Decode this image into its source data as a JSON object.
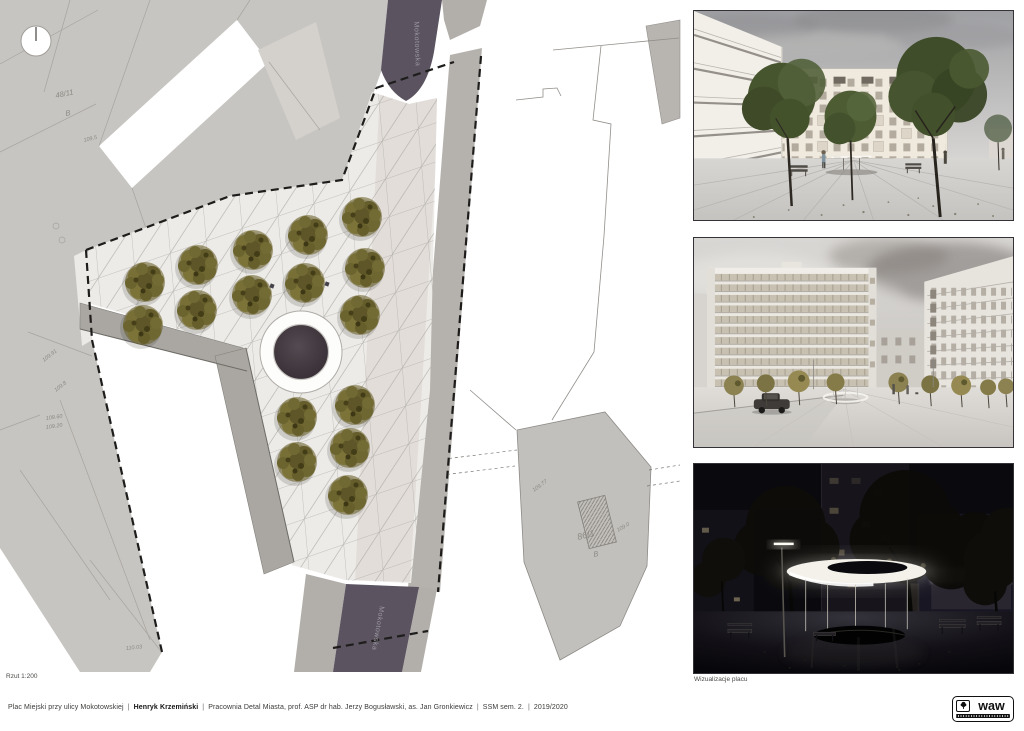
{
  "plan": {
    "caption": "Rzut 1:200",
    "street_top": "Mokotowska",
    "street_bottom": "Mokotowska",
    "tree_count": 16,
    "labels": [
      {
        "text": "48/11"
      },
      {
        "text": "B"
      },
      {
        "text": "109.5"
      },
      {
        "text": "109.91"
      },
      {
        "text": "109.8"
      },
      {
        "text": "109.60"
      },
      {
        "text": "109.20"
      },
      {
        "text": "110.03"
      },
      {
        "text": "86/1"
      },
      {
        "text": "B"
      },
      {
        "text": "109.77"
      },
      {
        "text": "109.0"
      }
    ],
    "colors": {
      "parcel": "#c7c5c1",
      "road": "#5b5460",
      "plaza": "#edebe7",
      "tree": "#6e662f",
      "pool": "#463d44"
    }
  },
  "renders": {
    "caption": "Wizualizacje placu"
  },
  "footer": {
    "separator": "|",
    "project": "Plac Miejski przy ulicy Mokotowskiej",
    "author": "Henryk Krzemiński",
    "studio": "Pracownia Detal Miasta, prof. ASP dr hab. Jerzy Bogusławski, as. Jan Gronkiewicz",
    "semester": "SSM sem. 2.",
    "year": "2019/2020"
  },
  "logo": {
    "text": "waw"
  }
}
